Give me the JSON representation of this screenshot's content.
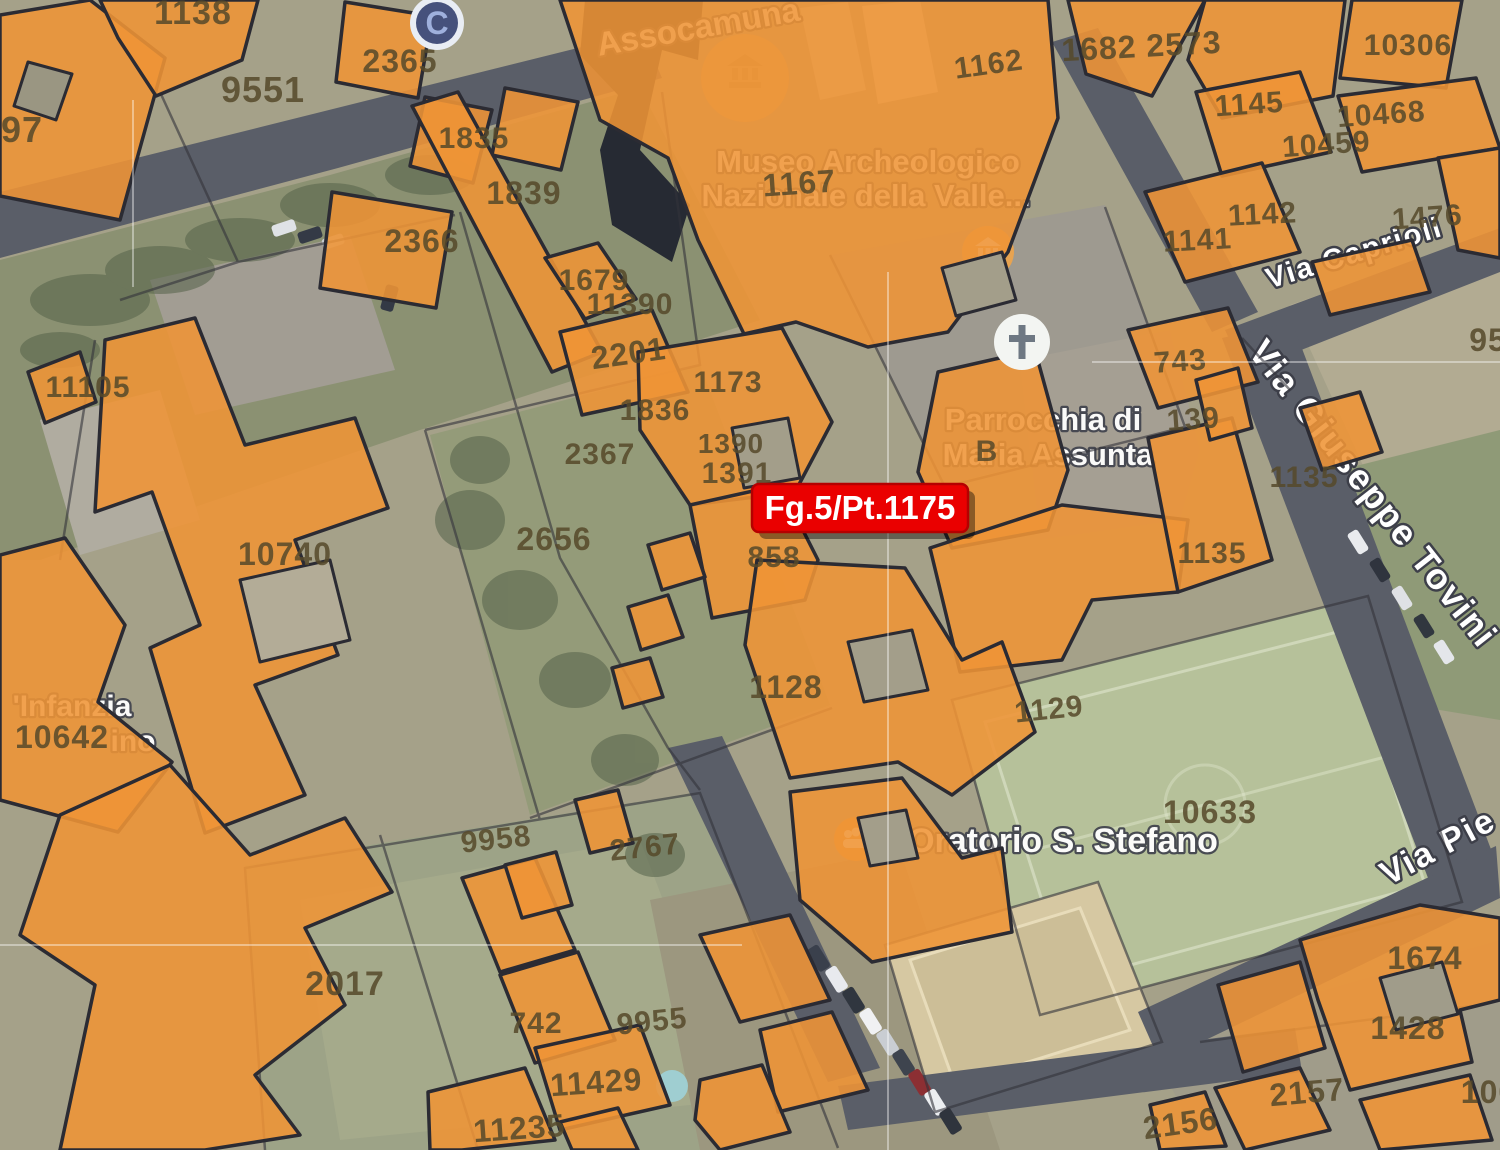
{
  "map": {
    "marker": {
      "label": "Fg.5/Pt.1175",
      "color": "#E90000"
    },
    "colors": {
      "parcel_overlay": "#EF9435",
      "road": "#5A5E68",
      "boundary": "#33333B"
    },
    "streets": {
      "caprioli": "Via Caprioli",
      "tovini": "Via Giuseppe Tovini",
      "pie": "Via Pie"
    },
    "pois": {
      "assoc": "Assocamuna",
      "museo_line1": "Museo Archeologico",
      "museo_line2": "Nazionale della Valle...",
      "parrocchia_line1": "Parrocchia di",
      "parrocchia_line2": "Maria Assunta",
      "oratorio": "Oratorio S. Stefano",
      "infanzia": "'Infanzia",
      "infanzia2": "ino",
      "c_badge": "C"
    },
    "parcel_labels": [
      {
        "t": "1138",
        "x": 193,
        "y": 24,
        "s": 34
      },
      {
        "t": "9551",
        "x": 263,
        "y": 102,
        "s": 36
      },
      {
        "t": "97",
        "x": 22,
        "y": 142,
        "s": 36
      },
      {
        "t": "2365",
        "x": 400,
        "y": 72,
        "s": 32
      },
      {
        "t": "1835",
        "x": 474,
        "y": 148,
        "s": 30
      },
      {
        "t": "2366",
        "x": 422,
        "y": 252,
        "s": 32
      },
      {
        "t": "1839",
        "x": 524,
        "y": 204,
        "s": 32
      },
      {
        "t": "1679",
        "x": 594,
        "y": 290,
        "s": 30
      },
      {
        "t": "11390",
        "x": 630,
        "y": 314,
        "s": 30
      },
      {
        "t": "2201",
        "x": 630,
        "y": 364,
        "s": 32,
        "r": -8
      },
      {
        "t": "1173",
        "x": 728,
        "y": 392,
        "s": 30
      },
      {
        "t": "1836",
        "x": 655,
        "y": 420,
        "s": 30
      },
      {
        "t": "2367",
        "x": 600,
        "y": 464,
        "s": 30
      },
      {
        "t": "1390",
        "x": 731,
        "y": 453,
        "s": 28
      },
      {
        "t": "1391",
        "x": 737,
        "y": 483,
        "s": 30
      },
      {
        "t": "2656",
        "x": 554,
        "y": 550,
        "s": 32
      },
      {
        "t": "858",
        "x": 774,
        "y": 567,
        "s": 30
      },
      {
        "t": "1128",
        "x": 786,
        "y": 698,
        "s": 32
      },
      {
        "t": "1129",
        "x": 1050,
        "y": 719,
        "s": 30,
        "r": -6
      },
      {
        "t": "10633",
        "x": 1210,
        "y": 823,
        "s": 32
      },
      {
        "t": "10740",
        "x": 285,
        "y": 565,
        "s": 32
      },
      {
        "t": "11105",
        "x": 88,
        "y": 397,
        "s": 30
      },
      {
        "t": "10642",
        "x": 62,
        "y": 748,
        "s": 32
      },
      {
        "t": "2017",
        "x": 345,
        "y": 995,
        "s": 34
      },
      {
        "t": "9958",
        "x": 497,
        "y": 849,
        "s": 30,
        "r": -6
      },
      {
        "t": "2767",
        "x": 646,
        "y": 857,
        "s": 30,
        "r": -6
      },
      {
        "t": "742",
        "x": 536,
        "y": 1033,
        "s": 30
      },
      {
        "t": "9955",
        "x": 653,
        "y": 1031,
        "s": 30,
        "r": -6
      },
      {
        "t": "11429",
        "x": 597,
        "y": 1093,
        "s": 32,
        "r": -4
      },
      {
        "t": "11235",
        "x": 520,
        "y": 1139,
        "s": 32,
        "r": -4
      },
      {
        "t": "1674",
        "x": 1425,
        "y": 969,
        "s": 32
      },
      {
        "t": "1428",
        "x": 1408,
        "y": 1039,
        "s": 32
      },
      {
        "t": "2157",
        "x": 1308,
        "y": 1103,
        "s": 32,
        "r": -5
      },
      {
        "t": "2156",
        "x": 1182,
        "y": 1134,
        "s": 32,
        "r": -8
      },
      {
        "t": "100",
        "x": 1489,
        "y": 1103,
        "s": 32
      },
      {
        "t": "1682 2573",
        "x": 1142,
        "y": 57,
        "s": 32,
        "r": -3
      },
      {
        "t": "1162",
        "x": 990,
        "y": 74,
        "s": 30,
        "r": -8
      },
      {
        "t": "10306",
        "x": 1408,
        "y": 55,
        "s": 30
      },
      {
        "t": "1145",
        "x": 1250,
        "y": 114,
        "s": 30,
        "r": -4
      },
      {
        "t": "10468",
        "x": 1382,
        "y": 124,
        "s": 30,
        "r": -4
      },
      {
        "t": "10459",
        "x": 1327,
        "y": 154,
        "s": 30,
        "r": -4
      },
      {
        "t": "1142",
        "x": 1263,
        "y": 224,
        "s": 30,
        "r": -3
      },
      {
        "t": "1141",
        "x": 1198,
        "y": 250,
        "s": 30,
        "r": -3
      },
      {
        "t": "1476",
        "x": 1428,
        "y": 227,
        "s": 30,
        "r": -4
      },
      {
        "t": "95",
        "x": 1488,
        "y": 351,
        "s": 32
      },
      {
        "t": "743",
        "x": 1181,
        "y": 371,
        "s": 30,
        "r": -4
      },
      {
        "t": "139",
        "x": 1194,
        "y": 429,
        "s": 30,
        "r": -4
      },
      {
        "t": "1135",
        "x": 1212,
        "y": 563,
        "s": 30
      },
      {
        "t": "1135",
        "x": 1304,
        "y": 487,
        "s": 30
      },
      {
        "t": "1167",
        "x": 800,
        "y": 194,
        "s": 32,
        "r": -4
      },
      {
        "t": "B",
        "x": 987,
        "y": 461,
        "s": 30
      }
    ]
  }
}
